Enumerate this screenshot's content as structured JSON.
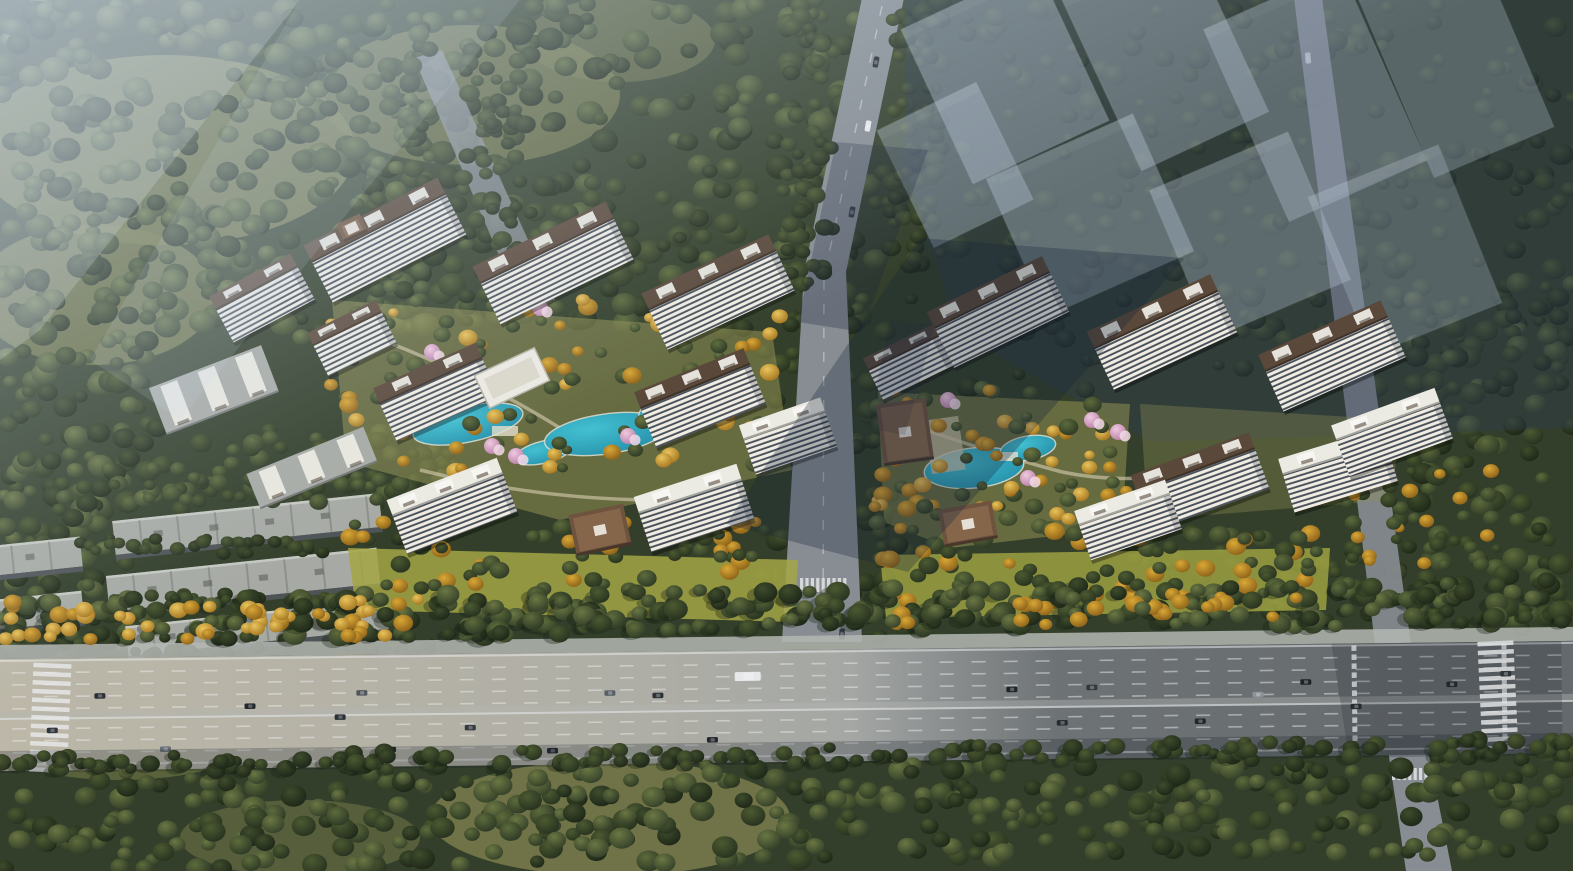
{
  "meta": {
    "title": "Aerial masterplan rendering of a residential development",
    "type": "architectural-visualization",
    "width_px": 1573,
    "height_px": 871
  },
  "scene": {
    "description": "Bird's-eye architectural rendering: two completed clusters of tan mid-rise apartment towers with brown roofs and white rooftop units stand in landscaped courtyards with turquoise pools, golden and green trees and pink blossom trees. Dense forest surrounds the site. A bright sunlit haze washes the upper-left corner. Semi-transparent massing of a future phase occupies the upper right and casts long diagonal shadows. Tree-lined access roads run between the clusters; a wide multi-lane arterial road with light traffic and crosswalks crosses the full width near the bottom, with a signalized intersection at the lower right. Rows of long low grey buildings sit at the lower left.",
    "regions": [
      "forest-floor",
      "meadows",
      "forest-canopy",
      "access-roads",
      "existing-low-buildings",
      "left-residential-cluster",
      "right-residential-cluster",
      "ghost-phase-buildings",
      "arterial-highway",
      "highway-tree-belts",
      "cast-shadows",
      "sunlight-haze"
    ],
    "features": [
      "dense forest surroundings",
      "sunlit blue-white haze from upper left",
      "two residential clusters of striped-facade towers",
      "courtyards with turquoise pools, golden trees, pink blossoms",
      "brown Chinese-style entrance pavilions",
      "translucent future-phase building massing casting shadows",
      "tree-lined vertical access roads with crosswalks",
      "wide multi-lane arterial road with cars and a white truck",
      "intersection with zebra crossings at lower right",
      "three long grey low-rise slabs at lower left"
    ],
    "palette": {
      "forest_base": "#333f2a",
      "meadow": "#75794a",
      "meadow_light": "#8f8f52",
      "lawn_bright": "#a3a644",
      "haze": "#cfdff2",
      "ghost_building": "#b7c5d6",
      "ghost_tint": "#2b3c58",
      "shadow": "#18243c",
      "road": "#878d92",
      "road_dark": "#646b72",
      "highway": "#a3a6a4",
      "highway_warm": "#d6c9ab",
      "sidewalk": "#b4b7b3",
      "lane": "#e8eaeb",
      "facade": "#f0ece2",
      "facade_stripe": "#39424e",
      "roof": "#5a483a",
      "roof_white": "#ecebe3",
      "podium": "#6e543f",
      "pool": "#43c0d2",
      "pool_deep": "#2792ab",
      "tree_gold": "#d9a62f",
      "tree_pink": "#e7bcd9",
      "path": "#d8cdb2",
      "slab_roof": "#a7aaa4",
      "slab_side": "#4e5356",
      "car_dark": "#23282c",
      "car_white": "#e6e8ea",
      "car_red": "#b5372c"
    }
  }
}
